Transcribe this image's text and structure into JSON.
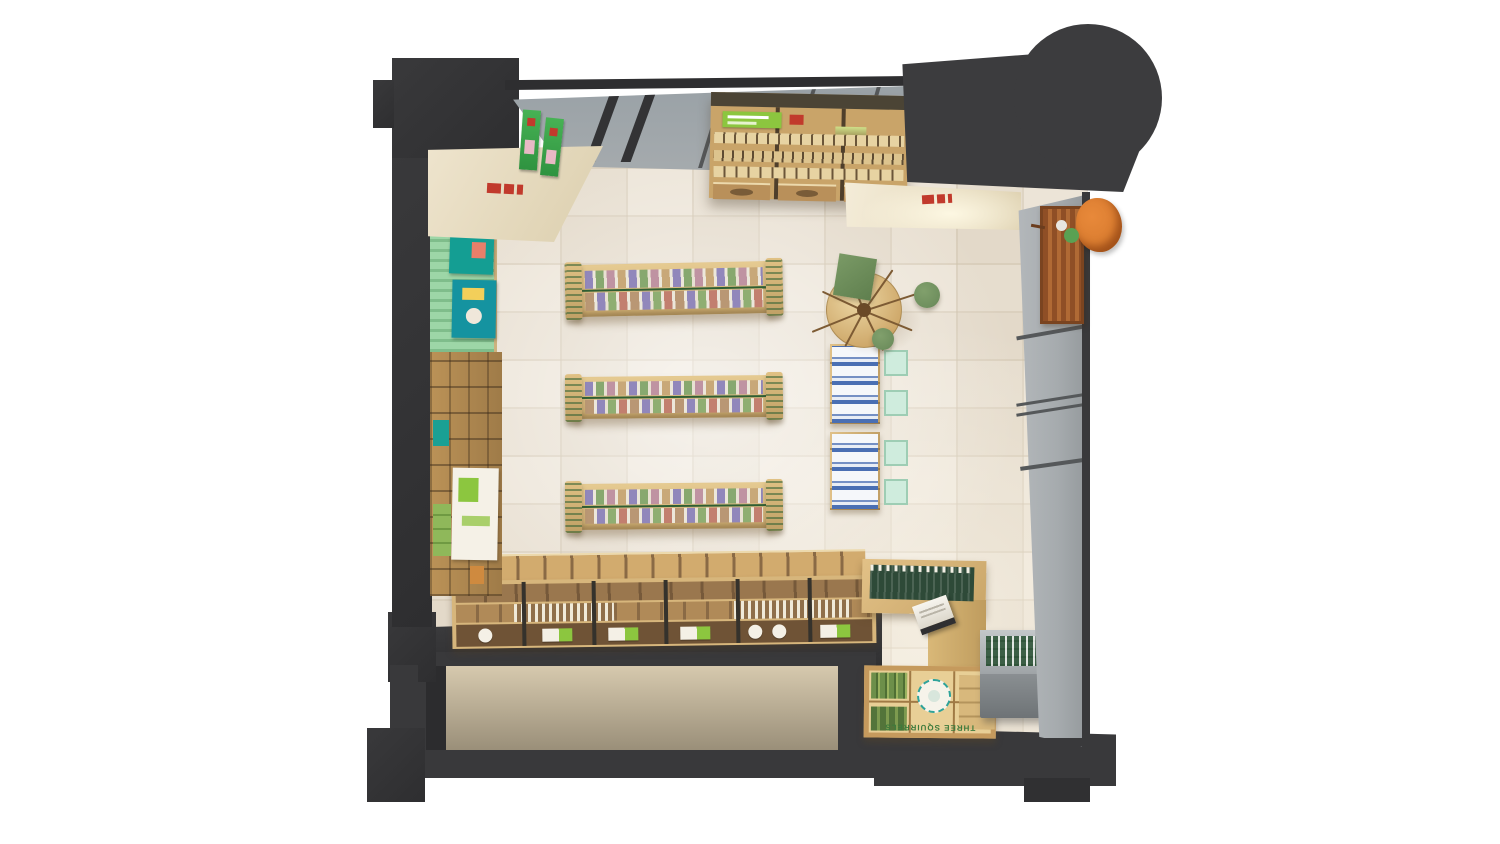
{
  "scene": {
    "description": "Top-down 3D render of a snack retail shop interior with wooden fixtures",
    "signs": {
      "tray_sign": "THREE SQUIRRELS"
    },
    "objects": [
      "dark-perimeter-walls",
      "skylight-glass-band",
      "canopy-blob",
      "ceiling-bulkheads",
      "green-slatwall",
      "left-shelf-stack",
      "top-wall-shelf-unit",
      "three-gondola-shelves",
      "blue-packet-racks",
      "round-display-table-with-branches",
      "bottom-product-counter",
      "cashier-counter",
      "bottle-fridge",
      "tray-display",
      "glass-storefront-right",
      "wood-bench",
      "orange-beanbag-chair",
      "cutaway-lower-room"
    ]
  },
  "palette": {
    "wall": "#39393b",
    "wallDeep": "#2e2e30",
    "glass": "#a6abae",
    "glassLight": "#b6babd",
    "mullion": "#55585a",
    "floor": "#ece4d7",
    "ceiling": "#eee4cd",
    "ceilingDeep": "#dccfae",
    "wood": "#d7b67c",
    "woodLight": "#e8d3a0",
    "woodMid": "#c9a469",
    "woodDeep": "#a5834f",
    "brown": "#8a6a47",
    "brownDark": "#6f5336",
    "slatGreen": "#9dd6a7",
    "slatGreenDeep": "#7fbd8b",
    "teal": "#149e93",
    "bannerGreen": "#8cc63f",
    "leafGreen": "#6f8f5e",
    "counterGreen": "#2e4a38",
    "mint": "#cfecdd",
    "blue": "#4a6fb3",
    "orange": "#d77a2e",
    "bench": "#9a5a2c",
    "red": "#c13a2c",
    "white": "#f4f0e6",
    "signGreen": "#3c7a3c"
  }
}
